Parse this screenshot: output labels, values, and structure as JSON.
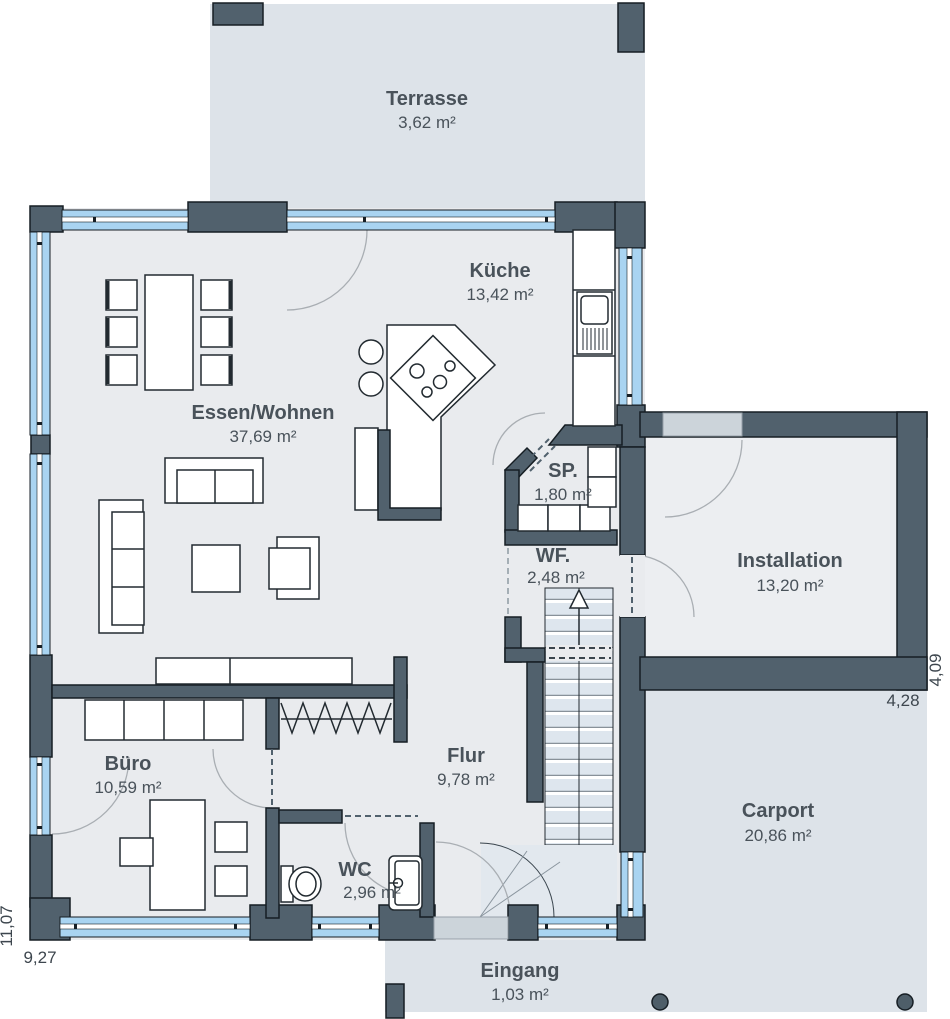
{
  "colors": {
    "wall": "#51616d",
    "window_glass": "#a9d4f1",
    "floor": "#e9ebee",
    "exterior_zone": "#dde3e9",
    "stair_tread": "#dee6ee",
    "door_leaf": "#ccd4da",
    "label_text": "#49525a"
  },
  "rooms": {
    "terrasse": {
      "name": "Terrasse",
      "area": "3,62 m²"
    },
    "kueche": {
      "name": "Küche",
      "area": "13,42 m²"
    },
    "essen_wohnen": {
      "name": "Essen/Wohnen",
      "area": "37,69 m²"
    },
    "sp": {
      "name": "SP.",
      "area": "1,80 m²"
    },
    "wf": {
      "name": "WF.",
      "area": "2,48 m²"
    },
    "installation": {
      "name": "Installation",
      "area": "13,20 m²"
    },
    "buero": {
      "name": "Büro",
      "area": "10,59 m²"
    },
    "flur": {
      "name": "Flur",
      "area": "9,78 m²"
    },
    "wc": {
      "name": "WC",
      "area": "2,96 m²"
    },
    "carport": {
      "name": "Carport",
      "area": "20,86 m²"
    },
    "eingang": {
      "name": "Eingang",
      "area": "1,03 m²"
    }
  },
  "dimensions": {
    "left_side": "11,07",
    "bottom_side": "9,27",
    "wing_right_side": "4,09",
    "wing_bottom_side": "4,28"
  }
}
